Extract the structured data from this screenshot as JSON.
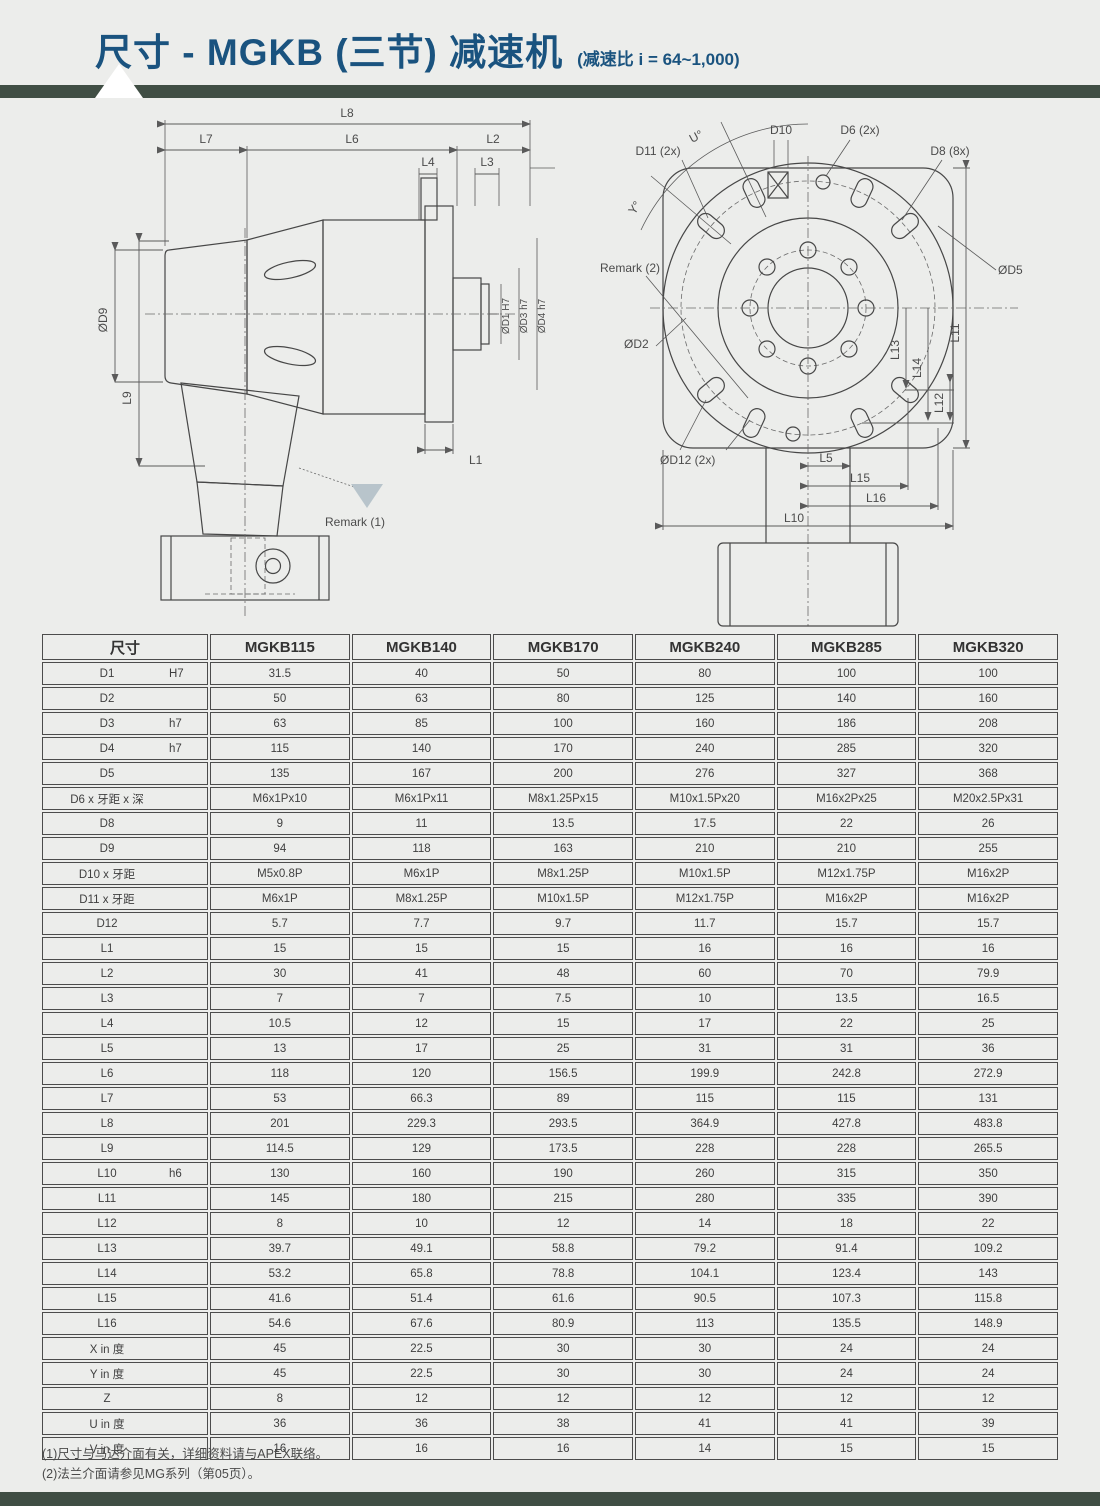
{
  "header": {
    "title": "尺寸 - MGKB (三节) 减速机",
    "subtitle": "(减速比 i = 64~1,000)"
  },
  "colors": {
    "page_bg": "#ecedeb",
    "accent_bar": "#404e44",
    "title_blue": "#1a537f",
    "drawing_line": "#4a4a4a",
    "remark_triangle": "#b8c4cb"
  },
  "drawings": {
    "left": {
      "name": "side-view",
      "labels": {
        "l8": "L8",
        "l7": "L7",
        "l6": "L6",
        "l2": "L2",
        "l4": "L4",
        "l3": "L3",
        "d9": "ØD9",
        "l9": "L9",
        "l1": "L1",
        "d1": "ØD1 H7",
        "d3": "ØD3 h7",
        "d4": "ØD4 h7",
        "remark1": "Remark (1)"
      }
    },
    "right": {
      "name": "front-view",
      "labels": {
        "u": "U°",
        "y": "Y°",
        "d10": "D10",
        "d11": "D11 (2x)",
        "d6": "D6 (2x)",
        "d8": "D8 (8x)",
        "d5": "ØD5",
        "d2": "ØD2",
        "d12": "ØD12 (2x)",
        "remark2": "Remark (2)",
        "l5": "L5",
        "l15": "L15",
        "l16": "L16",
        "l10": "L10",
        "l11": "L11",
        "l12": "L12",
        "l13": "L13",
        "l14": "L14"
      }
    }
  },
  "table": {
    "dim_header": "尺寸",
    "columns": [
      "MGKB115",
      "MGKB140",
      "MGKB170",
      "MGKB240",
      "MGKB285",
      "MGKB320"
    ],
    "rows": [
      {
        "label": "D1",
        "tol": "H7",
        "values": [
          "31.5",
          "40",
          "50",
          "80",
          "100",
          "100"
        ]
      },
      {
        "label": "D2",
        "tol": "",
        "values": [
          "50",
          "63",
          "80",
          "125",
          "140",
          "160"
        ]
      },
      {
        "label": "D3",
        "tol": "h7",
        "values": [
          "63",
          "85",
          "100",
          "160",
          "186",
          "208"
        ]
      },
      {
        "label": "D4",
        "tol": "h7",
        "values": [
          "115",
          "140",
          "170",
          "240",
          "285",
          "320"
        ]
      },
      {
        "label": "D5",
        "tol": "",
        "values": [
          "135",
          "167",
          "200",
          "276",
          "327",
          "368"
        ]
      },
      {
        "label": "D6 x 牙距 x 深",
        "tol": "",
        "values": [
          "M6x1Px10",
          "M6x1Px11",
          "M8x1.25Px15",
          "M10x1.5Px20",
          "M16x2Px25",
          "M20x2.5Px31"
        ]
      },
      {
        "label": "D8",
        "tol": "",
        "values": [
          "9",
          "11",
          "13.5",
          "17.5",
          "22",
          "26"
        ]
      },
      {
        "label": "D9",
        "tol": "",
        "values": [
          "94",
          "118",
          "163",
          "210",
          "210",
          "255"
        ]
      },
      {
        "label": "D10 x 牙距",
        "tol": "",
        "values": [
          "M5x0.8P",
          "M6x1P",
          "M8x1.25P",
          "M10x1.5P",
          "M12x1.75P",
          "M16x2P"
        ]
      },
      {
        "label": "D11 x 牙距",
        "tol": "",
        "values": [
          "M6x1P",
          "M8x1.25P",
          "M10x1.5P",
          "M12x1.75P",
          "M16x2P",
          "M16x2P"
        ]
      },
      {
        "label": "D12",
        "tol": "",
        "values": [
          "5.7",
          "7.7",
          "9.7",
          "11.7",
          "15.7",
          "15.7"
        ]
      },
      {
        "label": "L1",
        "tol": "",
        "values": [
          "15",
          "15",
          "15",
          "16",
          "16",
          "16"
        ]
      },
      {
        "label": "L2",
        "tol": "",
        "values": [
          "30",
          "41",
          "48",
          "60",
          "70",
          "79.9"
        ]
      },
      {
        "label": "L3",
        "tol": "",
        "values": [
          "7",
          "7",
          "7.5",
          "10",
          "13.5",
          "16.5"
        ]
      },
      {
        "label": "L4",
        "tol": "",
        "values": [
          "10.5",
          "12",
          "15",
          "17",
          "22",
          "25"
        ]
      },
      {
        "label": "L5",
        "tol": "",
        "values": [
          "13",
          "17",
          "25",
          "31",
          "31",
          "36"
        ]
      },
      {
        "label": "L6",
        "tol": "",
        "values": [
          "118",
          "120",
          "156.5",
          "199.9",
          "242.8",
          "272.9"
        ]
      },
      {
        "label": "L7",
        "tol": "",
        "values": [
          "53",
          "66.3",
          "89",
          "115",
          "115",
          "131"
        ]
      },
      {
        "label": "L8",
        "tol": "",
        "values": [
          "201",
          "229.3",
          "293.5",
          "364.9",
          "427.8",
          "483.8"
        ]
      },
      {
        "label": "L9",
        "tol": "",
        "values": [
          "114.5",
          "129",
          "173.5",
          "228",
          "228",
          "265.5"
        ]
      },
      {
        "label": "L10",
        "tol": "h6",
        "values": [
          "130",
          "160",
          "190",
          "260",
          "315",
          "350"
        ]
      },
      {
        "label": "L11",
        "tol": "",
        "values": [
          "145",
          "180",
          "215",
          "280",
          "335",
          "390"
        ]
      },
      {
        "label": "L12",
        "tol": "",
        "values": [
          "8",
          "10",
          "12",
          "14",
          "18",
          "22"
        ]
      },
      {
        "label": "L13",
        "tol": "",
        "values": [
          "39.7",
          "49.1",
          "58.8",
          "79.2",
          "91.4",
          "109.2"
        ]
      },
      {
        "label": "L14",
        "tol": "",
        "values": [
          "53.2",
          "65.8",
          "78.8",
          "104.1",
          "123.4",
          "143"
        ]
      },
      {
        "label": "L15",
        "tol": "",
        "values": [
          "41.6",
          "51.4",
          "61.6",
          "90.5",
          "107.3",
          "115.8"
        ]
      },
      {
        "label": "L16",
        "tol": "",
        "values": [
          "54.6",
          "67.6",
          "80.9",
          "113",
          "135.5",
          "148.9"
        ]
      },
      {
        "label": "X in 度",
        "tol": "",
        "values": [
          "45",
          "22.5",
          "30",
          "30",
          "24",
          "24"
        ]
      },
      {
        "label": "Y in 度",
        "tol": "",
        "values": [
          "45",
          "22.5",
          "30",
          "30",
          "24",
          "24"
        ]
      },
      {
        "label": "Z",
        "tol": "",
        "values": [
          "8",
          "12",
          "12",
          "12",
          "12",
          "12"
        ]
      },
      {
        "label": "U in 度",
        "tol": "",
        "values": [
          "36",
          "36",
          "38",
          "41",
          "41",
          "39"
        ]
      },
      {
        "label": "V in 度",
        "tol": "",
        "values": [
          "16",
          "16",
          "16",
          "14",
          "15",
          "15"
        ]
      }
    ]
  },
  "footnotes": [
    "(1)尺寸与马达介面有关，详细资料请与APEX联络。",
    "(2)法兰介面请参见MG系列（第05页）。"
  ]
}
